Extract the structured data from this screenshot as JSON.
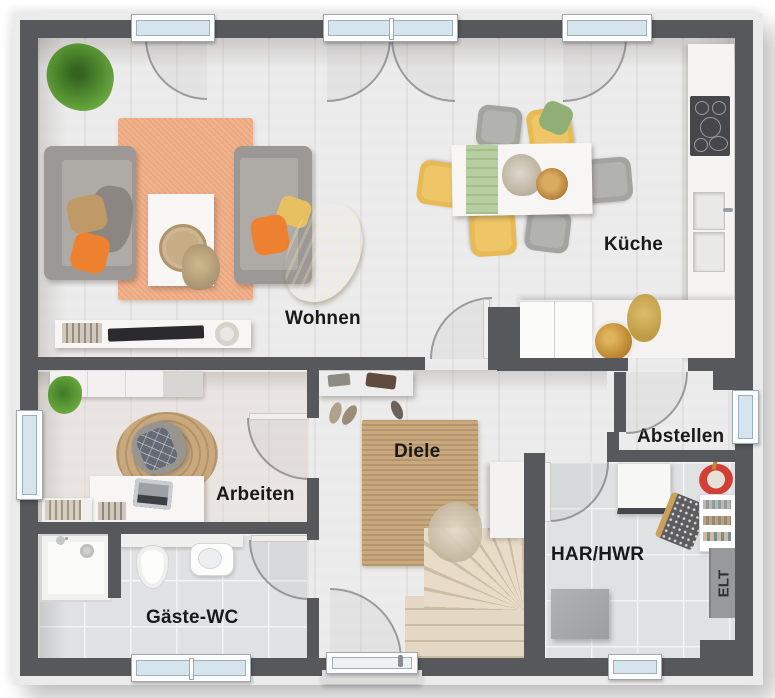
{
  "rooms": {
    "wohnen": {
      "label": "Wohnen"
    },
    "kueche": {
      "label": "Küche"
    },
    "arbeiten": {
      "label": "Arbeiten"
    },
    "gaeste_wc": {
      "label": "Gäste-WC"
    },
    "diele": {
      "label": "Diele"
    },
    "abstellen": {
      "label": "Abstellen"
    },
    "har_hwr": {
      "label": "HAR/HWR"
    },
    "elt": {
      "label": "ELT"
    }
  },
  "colors": {
    "wall": "#57585c",
    "wood_floor": "#d8cbbd",
    "tile_floor": "#dfe1e3",
    "rug_living": "#f1b28d",
    "rug_jute": "#c9a87e",
    "accent_orange": "#ee8130",
    "accent_yellow": "#e8ba55",
    "accent_green_runner": "#b7cfa0",
    "window_glass": "#d6e4ee"
  }
}
